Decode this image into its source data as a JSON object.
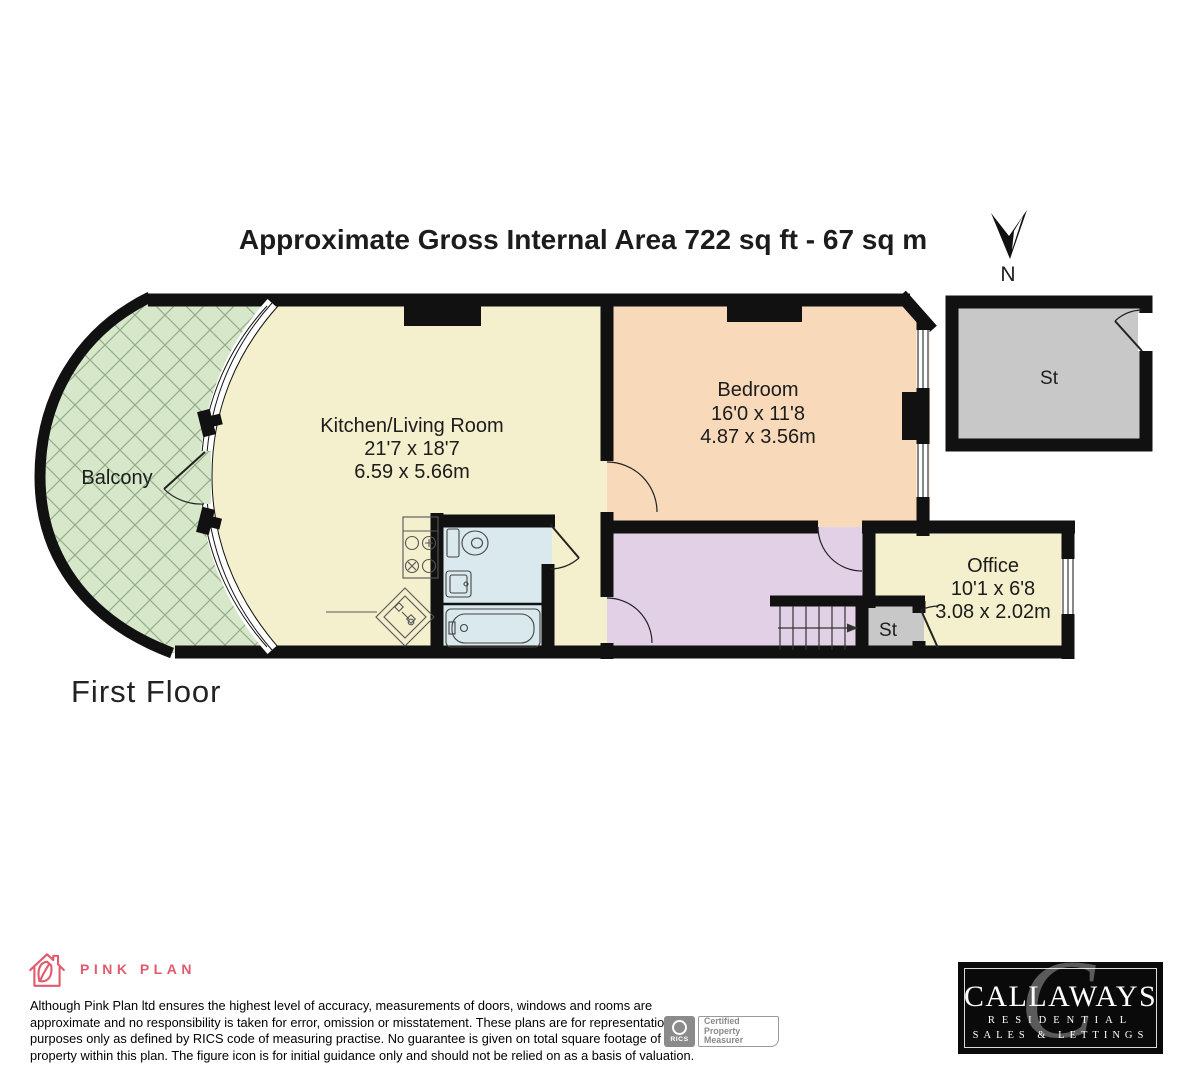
{
  "header": {
    "title": "Approximate Gross Internal Area 722 sq ft - 67 sq m",
    "compass_label": "N"
  },
  "floor_label": "First Floor",
  "rooms": {
    "balcony": {
      "name": "Balcony"
    },
    "kitchen_living": {
      "name": "Kitchen/Living Room",
      "dims_imperial": "21'7 x 18'7",
      "dims_metric": "6.59 x 5.66m"
    },
    "bedroom": {
      "name": "Bedroom",
      "dims_imperial": "16'0 x 11'8",
      "dims_metric": "4.87 x 3.56m"
    },
    "office": {
      "name": "Office",
      "dims_imperial": "10'1 x 6'8",
      "dims_metric": "3.08 x 2.02m"
    },
    "storage_internal": {
      "name": "St"
    },
    "storage_external": {
      "name": "St"
    }
  },
  "colors": {
    "balcony": "#d7e7c9",
    "kitchen": "#f4efcc",
    "bedroom": "#f8d9ba",
    "hallway": "#e2d0e7",
    "bathroom": "#d9e9ed",
    "storage": "#c8c8c8",
    "walls": "#111111",
    "brand_pink": "#e25a6d"
  },
  "footer": {
    "brand_name": "PINK PLAN",
    "disclaimer_lines": [
      "Although Pink Plan ltd ensures the highest level of accuracy, measurements of doors, windows and rooms are",
      "approximate and no responsibility is taken for error, omission or misstatement. These plans are for representation",
      "purposes only as defined by RICS code of measuring practise. No guarantee is given on total square footage of the",
      "property within this plan. The figure icon is for initial guidance only and should not be relied on as a basis of valuation."
    ],
    "rics": {
      "logo_text": "RICS",
      "label_lines": [
        "Certified",
        "Property",
        "Measurer"
      ]
    },
    "agent": {
      "name": "CALLAWAYS",
      "tagline1": "RESIDENTIAL",
      "tagline2": "SALES & LETTINGS"
    }
  }
}
